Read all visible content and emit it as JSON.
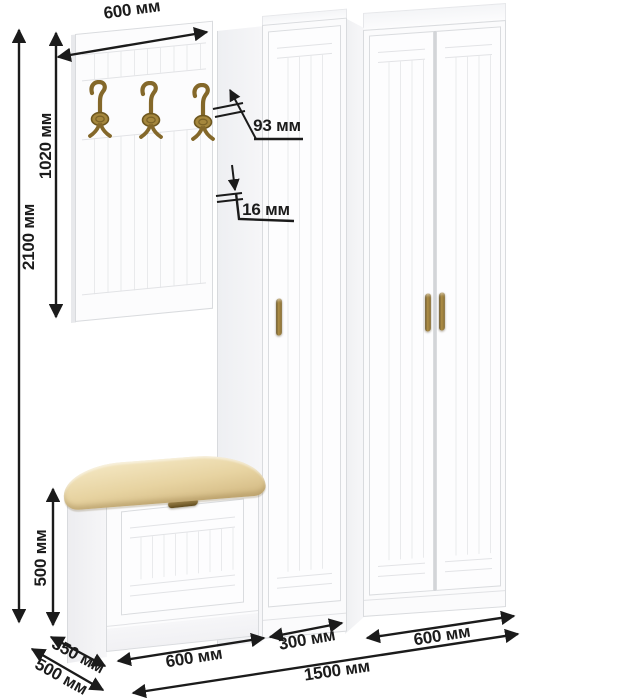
{
  "diagram": {
    "unit": "мм",
    "dimensions": {
      "top_width": "600 мм",
      "panel_height": "1020 мм",
      "total_height": "2100 мм",
      "hook_projection": "93 мм",
      "panel_thickness": "16 мм",
      "bench_height": "500 мм",
      "bench_depth": "350 мм",
      "total_depth": "500 мм",
      "bench_width": "600 мм",
      "middle_section_width": "300 мм",
      "right_section_width": "600 мм",
      "total_width": "1500 мм"
    },
    "colors": {
      "dimension_line": "#1b1b1b",
      "furniture_edge": "#d9dbde",
      "cushion": "#e7d3a1",
      "brass": "#84682a"
    },
    "icons": {
      "coat_hook": "coat-hook-icon",
      "door_handle": "door-handle-icon"
    }
  }
}
